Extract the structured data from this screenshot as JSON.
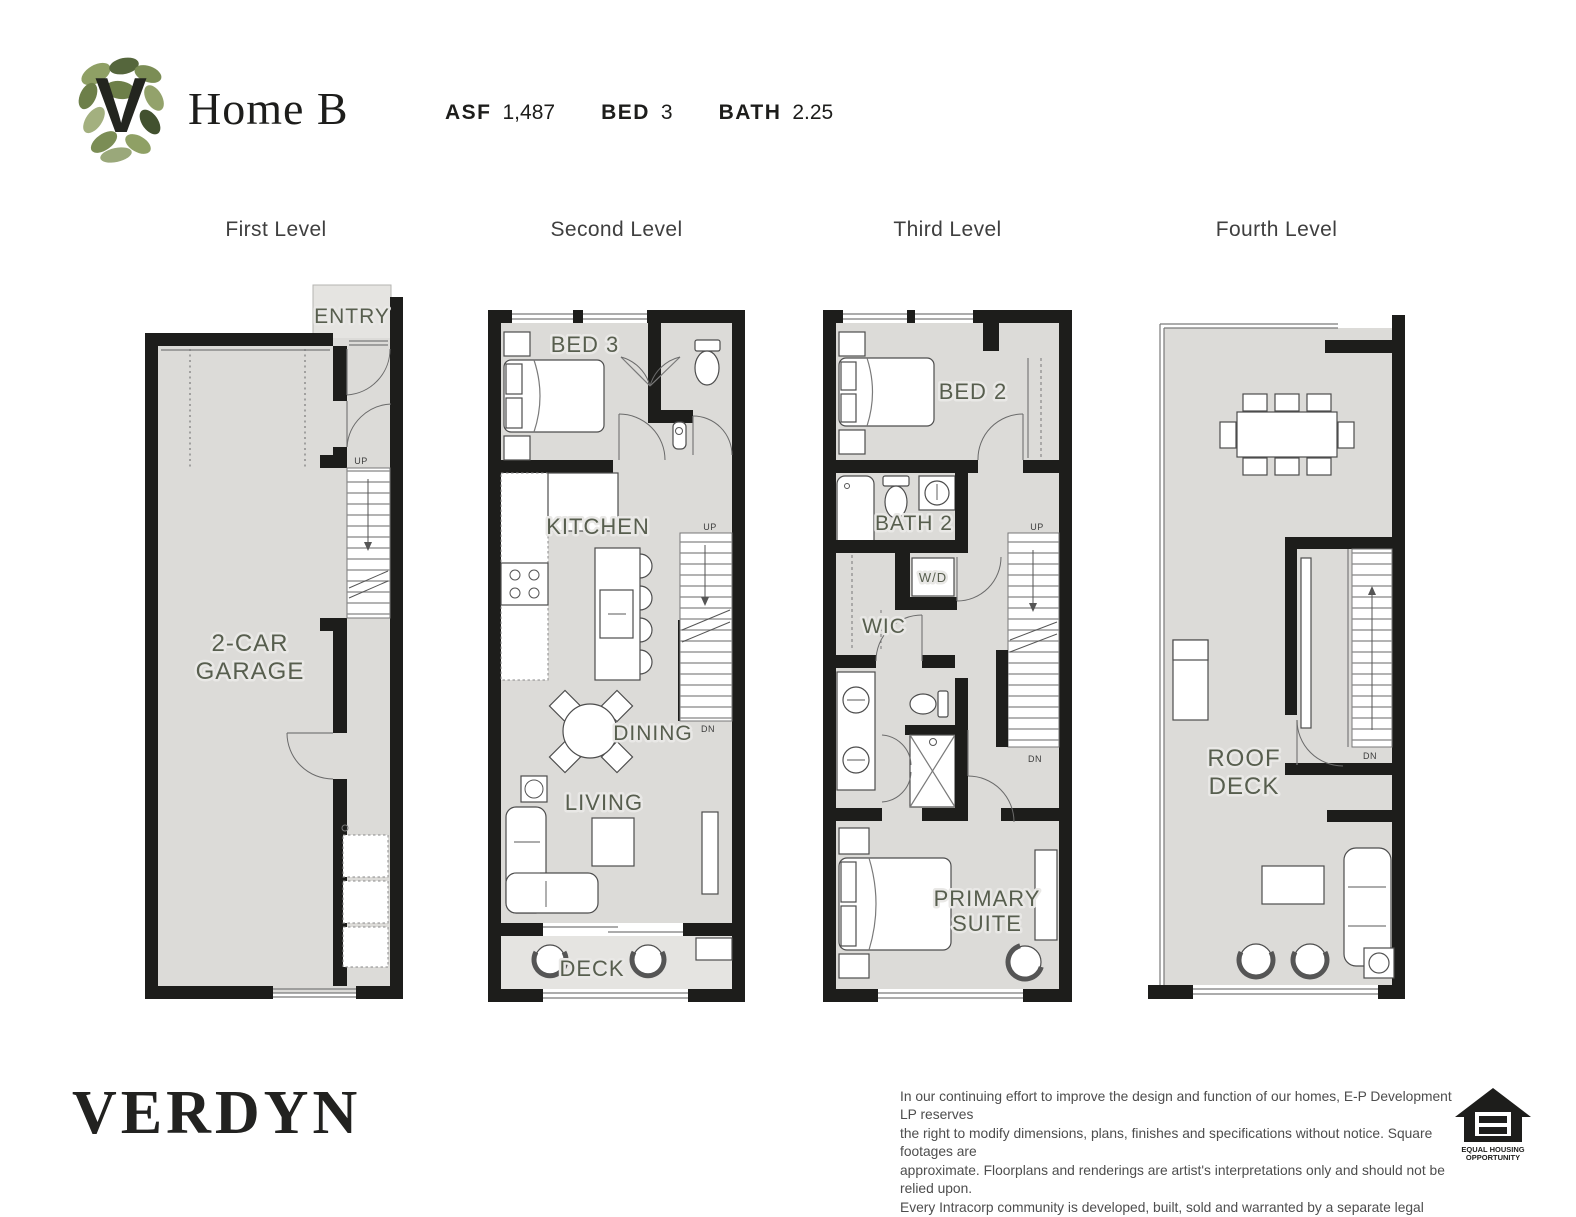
{
  "header": {
    "logo": "verdyn-leaf-logo",
    "title": "Home B",
    "stats": [
      {
        "label": "ASF",
        "value": "1,487"
      },
      {
        "label": "BED",
        "value": "3"
      },
      {
        "label": "BATH",
        "value": "2.25"
      }
    ]
  },
  "levels": [
    {
      "name": "First Level",
      "labels": {
        "entry": "ENTRY",
        "garage_line1": "2-CAR",
        "garage_line2": "GARAGE",
        "up": "UP"
      }
    },
    {
      "name": "Second Level",
      "labels": {
        "bed3": "BED 3",
        "kitchen": "KITCHEN",
        "dining": "DINING",
        "living": "LIVING",
        "deck": "DECK",
        "up": "UP",
        "dn": "DN"
      }
    },
    {
      "name": "Third Level",
      "labels": {
        "bed2": "BED 2",
        "bath2": "BATH 2",
        "wd": "W/D",
        "wic": "WIC",
        "primary_line1": "PRIMARY",
        "primary_line2": "SUITE",
        "up": "UP",
        "dn": "DN"
      }
    },
    {
      "name": "Fourth Level",
      "labels": {
        "roof_line1": "ROOF",
        "roof_line2": "DECK",
        "dn": "DN"
      }
    }
  ],
  "footer": {
    "brand": "VERDYN",
    "disclaimer_lines": [
      "In our continuing effort to improve the design and function of our homes, E-P Development LP reserves",
      "the right to modify dimensions, plans, finishes and specifications without notice. Square footages are",
      "approximate. Floorplans and renderings are artist's interpretations only and should not be relied upon.",
      "Every Intracorp community is developed, built, sold and warranted by a separate legal entity.   8/2025"
    ],
    "eho": {
      "line1": "EQUAL HOUSING",
      "line2": "OPPORTUNITY"
    }
  },
  "colors": {
    "wall": "#1d1d1b",
    "floor": "#dcdbd8",
    "floor_light": "#e5e4e1",
    "room_label": "#575e4e",
    "logo_green_dark": "#55663c",
    "logo_green_mid": "#7b8d55",
    "logo_green_light": "#a3b07f"
  }
}
